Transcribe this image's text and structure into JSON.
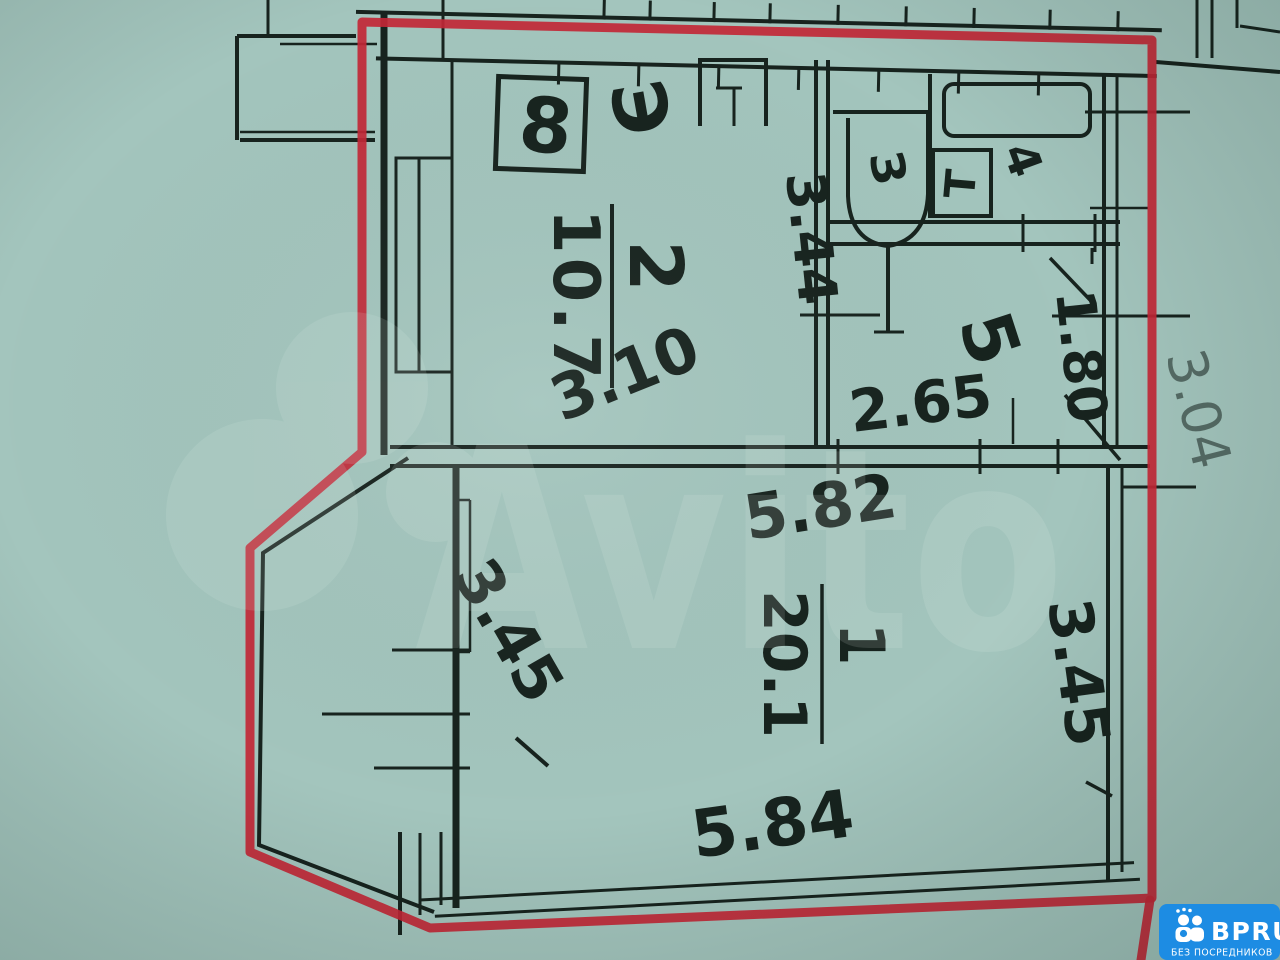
{
  "colors": {
    "paper": "#a3c5bd",
    "ink": "#17231e",
    "red_marker": "#c22736",
    "logo_blue": "#1d8ce3",
    "watermark": "#eaf5f0"
  },
  "plan": {
    "apartment_number": "8",
    "electric_symbol": "Э",
    "rooms": {
      "room1": {
        "number": "1",
        "area": "20.1",
        "top_width": "5.82",
        "bottom_width": "5.84",
        "left_height": "3.45",
        "right_height": "3.45"
      },
      "room2": {
        "number": "2",
        "area": "10.7",
        "width": "3.10",
        "depth": "3.44"
      },
      "room3": {
        "label": "З"
      },
      "room4": {
        "label": "4",
        "heater_label": "Т"
      },
      "room5": {
        "number": "5",
        "area": "2.65",
        "width": "1.80"
      }
    },
    "outer_dimension": "3.04"
  },
  "watermark": {
    "text": "Avito"
  },
  "logo": {
    "title": "BPRU",
    "subtitle": "БЕЗ ПОСРЕДНИКОВ"
  }
}
